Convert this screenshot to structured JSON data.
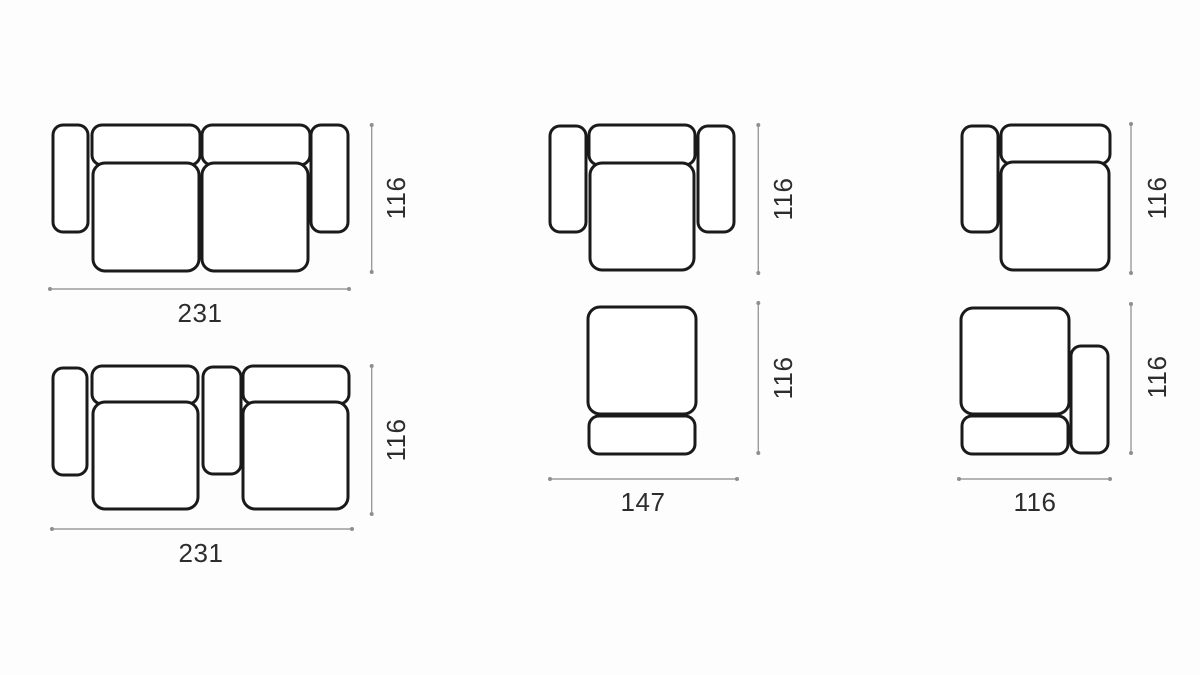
{
  "figure": {
    "title": "Modular sofa top-view dimension diagrams",
    "view": "top view line drawings with dimension lines"
  },
  "colors": {
    "background": "#fdfdfd",
    "outline": "#1a1a1a",
    "dimension_line": "#9b9b9b",
    "label_text": "#2d2d2d"
  },
  "diagrams": [
    {
      "id": "two-seat-sofa-both-arms",
      "position": "top-left",
      "parts": [
        "left-armrest",
        "backrest",
        "backrest",
        "right-armrest",
        "seat-cushion",
        "seat-cushion"
      ],
      "height": "116",
      "width": "231"
    },
    {
      "id": "armchair-both-arms",
      "position": "top-middle",
      "parts": [
        "left-armrest",
        "backrest",
        "seat-cushion",
        "right-armrest"
      ],
      "height": "116"
    },
    {
      "id": "module-left-arm",
      "position": "top-right",
      "parts": [
        "left-armrest",
        "backrest",
        "seat-cushion"
      ],
      "height": "116"
    },
    {
      "id": "two-seat-sofa-console",
      "position": "bottom-left",
      "parts": [
        "left-armrest",
        "backrest",
        "seat-cushion",
        "console",
        "backrest",
        "seat-cushion"
      ],
      "height": "116",
      "width": "231"
    },
    {
      "id": "chaise-module-footrest",
      "position": "bottom-middle",
      "parts": [
        "seat",
        "footrest"
      ],
      "height": "116",
      "width": "147"
    },
    {
      "id": "module-right-arm-footrest",
      "position": "bottom-right",
      "parts": [
        "seat",
        "footrest",
        "right-armrest"
      ],
      "height": "116",
      "width": "116"
    }
  ]
}
